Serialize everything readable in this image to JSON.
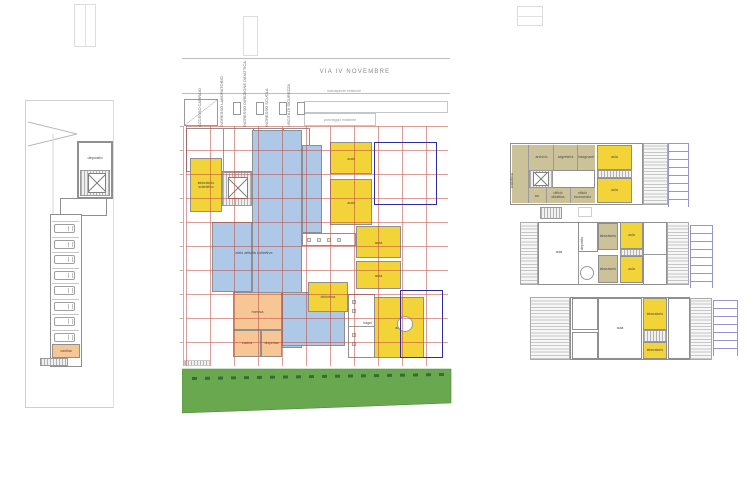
{
  "street": {
    "name": "VIA IV NOVEMBRE",
    "sidewalk_note": "marciapiede esistente",
    "canopy_note": "parcheggio esistente"
  },
  "entrance_labels": [
    "ACCESSO CARRAIO",
    "INGRESSO LABORATORIO",
    "INGRESSO DIREZIONE DIDATTICA",
    "INGRESSO SCUOLA",
    "USCITA DI SICUREZZA"
  ],
  "labels": {
    "aula": "aula",
    "laboratorio": "laboratorio",
    "laboratorio_scientifico": "laboratorio scientifico",
    "atrio": "atrio attività collettive",
    "biblioteca": "biblioteca",
    "mensa": "mensa",
    "cucina": "cucina",
    "dispensa": "dispensa",
    "bagni": "bagni",
    "deposito": "deposito",
    "cantina": "cantina",
    "archivio": "archivio",
    "segreteria": "segreteria",
    "insegnanti": "insegnanti",
    "wc": "wc",
    "ufficio_didattica": "ufficio didattica",
    "ufficio_economato": "ufficio economato"
  },
  "parking": {
    "stall_count": 8
  },
  "colors": {
    "room_yellow": "#F2D338",
    "room_blue": "#AEC8E8",
    "room_olive": "#CBC29A",
    "room_orange": "#F6C795",
    "lawn_green": "#69A84F",
    "grid_red": "#BE463C",
    "outline_blue": "#2E2EA0",
    "ladder_blue": "#9595D2"
  }
}
